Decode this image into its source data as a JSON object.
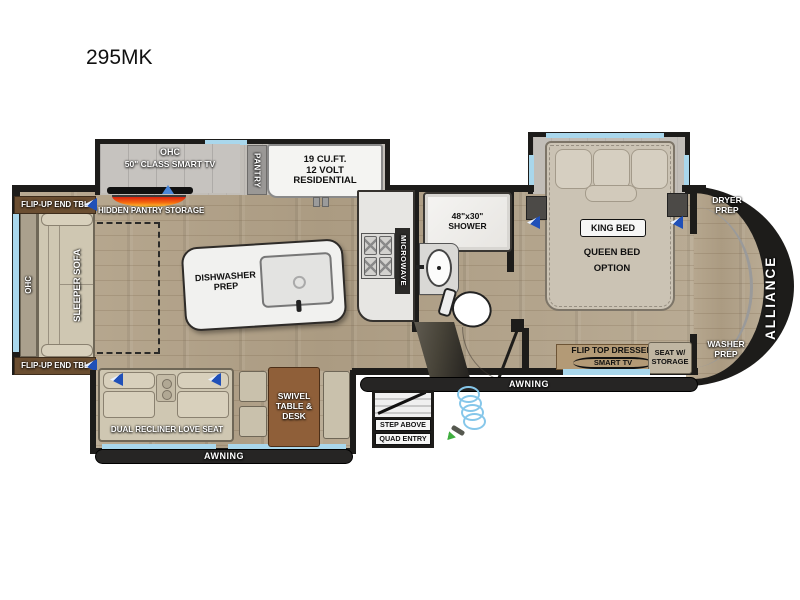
{
  "title": "295MK",
  "brand": "ALLIANCE",
  "labels": {
    "awning": "AWNING"
  },
  "living": {
    "ohc_cabinet": "OHC",
    "tv": "50\" CLASS SMART TV",
    "hidden_pantry": "HIDDEN PANTRY STORAGE",
    "flip_up_end_tbl": "FLIP-UP END TBL",
    "ohc_side": "OHC",
    "sleeper_sofa": "SLEEPER SOFA",
    "dual_recliner": "DUAL RECLINER LOVE SEAT",
    "swivel_table": "SWIVEL TABLE & DESK"
  },
  "kitchen": {
    "pantry": "PANTRY",
    "fridge_lines": [
      "19 CU.FT.",
      "12 VOLT",
      "RESIDENTIAL"
    ],
    "island": "DISHWASHER PREP",
    "microwave": "MICROWAVE"
  },
  "bath": {
    "shower_size": "48\"x30\"",
    "shower": "SHOWER"
  },
  "bedroom": {
    "king_bed": "KING BED",
    "queen_option": "QUEEN BED OPTION",
    "flip_top_dresser": "FLIP TOP DRESSER",
    "smart_tv": "SMART TV",
    "seat_storage": "SEAT W/ STORAGE"
  },
  "utility": {
    "dryer_prep": "DRYER PREP",
    "washer_prep": "WASHER PREP"
  },
  "entry": {
    "step_above": "STEP ABOVE",
    "quad_entry": "QUAD ENTRY"
  },
  "colors": {
    "wall": "#1d1c1a",
    "window": "#a9d7ec",
    "wood_floor": "#b3a289",
    "furniture_tan": "#cfc7b2",
    "table_brown": "#8f5f39",
    "speaker_blue": "#2050b8",
    "fireplace_orange": "#f4690f"
  }
}
